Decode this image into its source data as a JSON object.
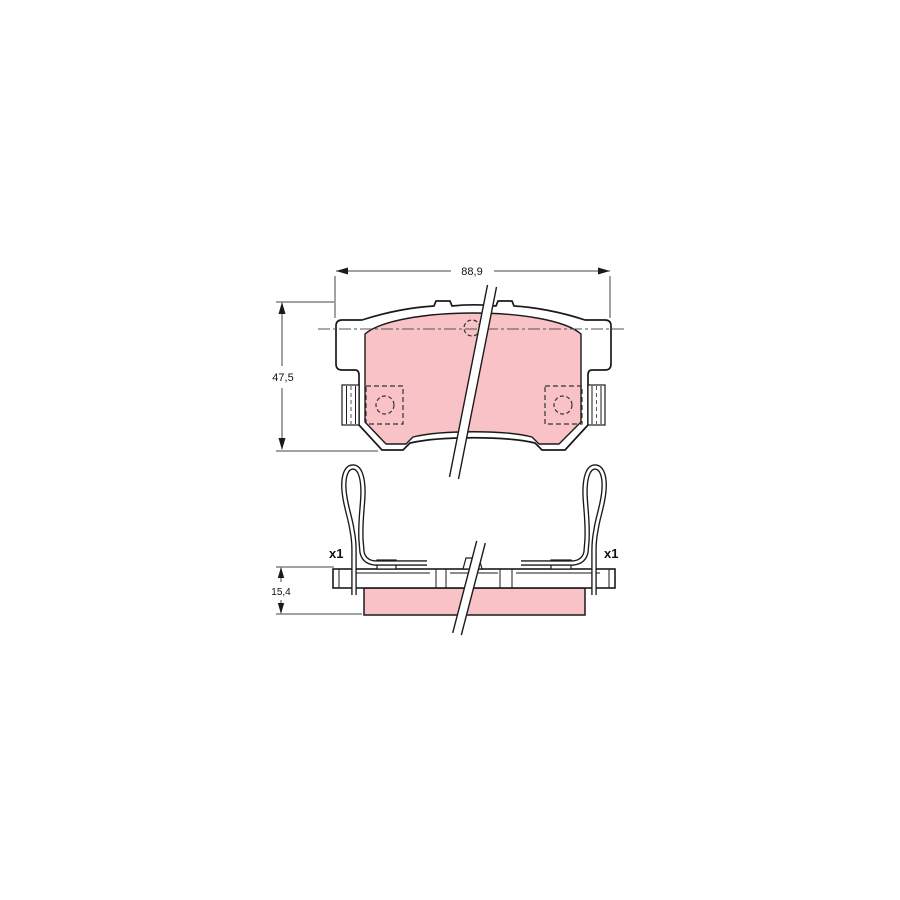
{
  "annotations": {
    "width_label": "88,9",
    "height_label": "47,5",
    "thickness_label": "15,4",
    "qty_left": "x1",
    "qty_right": "x1"
  },
  "colors": {
    "friction_material": "#f9c2c6",
    "outline": "#1a1a1a",
    "dimension_line": "#444444",
    "background": "#ffffff"
  }
}
